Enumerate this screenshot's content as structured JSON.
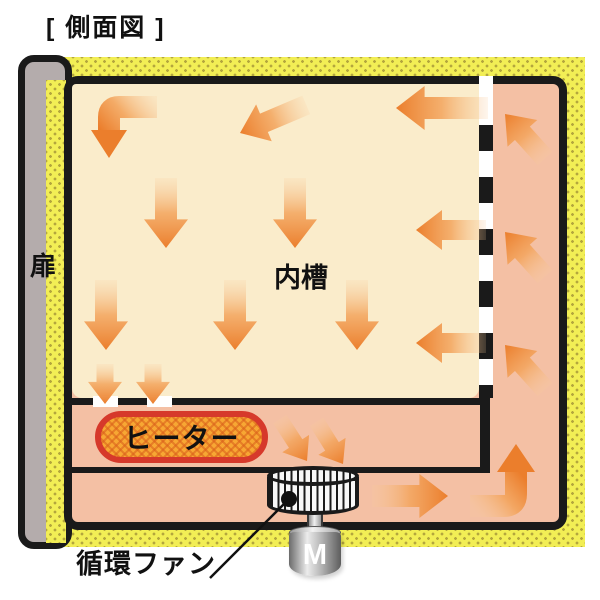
{
  "title": "[ 側面図 ]",
  "labels": {
    "door": "扉",
    "inner_chamber": "内槽",
    "heater": "ヒーター",
    "fan": "循環ファン",
    "motor": "M"
  },
  "colors": {
    "insulation_yellow": "#f2ee55",
    "insulation_dot": "#b3a63d",
    "duct_pink": "#f4c0a4",
    "chamber_cream": "#faeccb",
    "door_gray": "#b4acac",
    "outline_black": "#1a1a1a",
    "heater_fill": "#f7a733",
    "heater_border": "#d6392b",
    "arrow_head_orange": "#eb7e2c",
    "arrow_tail_orange": "#f8cb9b"
  },
  "airflow": {
    "straight_arrows": [
      {
        "name": "chamber-top-diagonal-left-arrow",
        "hx": 240,
        "hy": 133,
        "angle": 157,
        "len": 72,
        "w": 20
      },
      {
        "name": "chamber-top-left-arrow",
        "hx": 396,
        "hy": 108,
        "angle": 180,
        "len": 92,
        "w": 22
      },
      {
        "name": "chamber-mid-down-arrow-1",
        "hx": 166,
        "hy": 248,
        "angle": 90,
        "len": 70,
        "w": 22
      },
      {
        "name": "chamber-mid-down-arrow-2",
        "hx": 295,
        "hy": 248,
        "angle": 90,
        "len": 70,
        "w": 22
      },
      {
        "name": "chamber-mid-left-arrow",
        "hx": 416,
        "hy": 230,
        "angle": 180,
        "len": 70,
        "w": 20
      },
      {
        "name": "chamber-low-down-arrow-1",
        "hx": 106,
        "hy": 350,
        "angle": 90,
        "len": 70,
        "w": 22
      },
      {
        "name": "chamber-low-down-arrow-2",
        "hx": 235,
        "hy": 350,
        "angle": 90,
        "len": 70,
        "w": 22
      },
      {
        "name": "chamber-low-down-arrow-3",
        "hx": 357,
        "hy": 350,
        "angle": 90,
        "len": 70,
        "w": 22
      },
      {
        "name": "chamber-low-left-arrow",
        "hx": 416,
        "hy": 343,
        "angle": 180,
        "len": 70,
        "w": 20
      },
      {
        "name": "vent-down-arrow-1",
        "hx": 105,
        "hy": 404,
        "angle": 90,
        "len": 40,
        "w": 17
      },
      {
        "name": "vent-down-arrow-2",
        "hx": 153,
        "hy": 404,
        "angle": 90,
        "len": 40,
        "w": 17
      },
      {
        "name": "heater-to-fan-arrow-1",
        "hx": 307,
        "hy": 461,
        "angle": 57,
        "len": 50,
        "w": 16
      },
      {
        "name": "heater-to-fan-arrow-2",
        "hx": 343,
        "hy": 464,
        "angle": 58,
        "len": 50,
        "w": 16
      },
      {
        "name": "bottom-duct-right-arrow",
        "hx": 448,
        "hy": 496,
        "angle": 0,
        "len": 76,
        "w": 22
      },
      {
        "name": "right-duct-up-arrow-1",
        "hx": 505,
        "hy": 114,
        "angle": -132,
        "len": 60,
        "w": 20
      },
      {
        "name": "right-duct-up-arrow-2",
        "hx": 505,
        "hy": 232,
        "angle": -132,
        "len": 60,
        "w": 20
      },
      {
        "name": "right-duct-up-arrow-3",
        "hx": 505,
        "hy": 345,
        "angle": -132,
        "len": 60,
        "w": 20
      }
    ],
    "elbow_arrows": [
      {
        "name": "chamber-topleft-elbow-arrow",
        "stroke": "M157,107 L119,107 Q109,107 109,117 L109,131",
        "w": 22,
        "head": "91,130 127,130 109,158",
        "gx1": 157,
        "gy1": 100,
        "gx2": 109,
        "gy2": 140
      },
      {
        "name": "bottom-corner-elbow-arrow",
        "stroke": "M470,506 L504,506 Q516,506 516,494 L516,471",
        "w": 22,
        "head": "497,472 535,472 516,444",
        "gx1": 470,
        "gy1": 506,
        "gx2": 516,
        "gy2": 468
      }
    ]
  },
  "callout": {
    "x1": 210,
    "y1": 578,
    "x2": 289,
    "y2": 499,
    "dot_x": 289,
    "dot_y": 499,
    "dot_r": 8
  },
  "partition_dashes": {
    "first_y": 49,
    "height": 26,
    "gap": 26,
    "count": 6
  }
}
